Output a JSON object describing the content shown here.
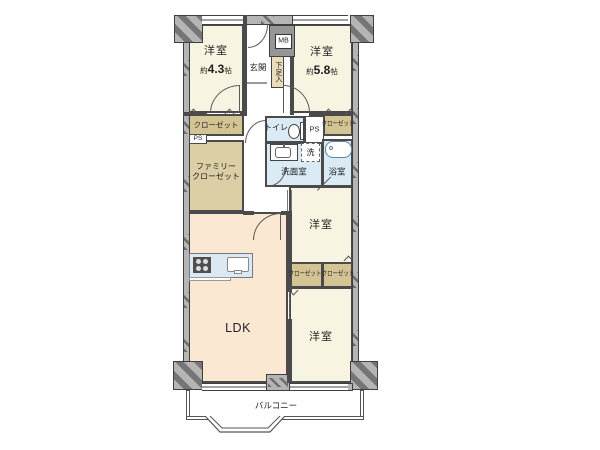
{
  "plan": {
    "rooms": {
      "bedroom_tl": {
        "label": "洋室",
        "size_approx": "約",
        "size_value": "4.3",
        "size_unit": "帖"
      },
      "bedroom_tr": {
        "label": "洋室",
        "size_approx": "約",
        "size_value": "5.8",
        "size_unit": "帖"
      },
      "entrance": {
        "label": "玄関"
      },
      "meter_box": {
        "label": "MB"
      },
      "shoe_cabinet": {
        "label": "下足入"
      },
      "closet_tl": {
        "label": "クローゼット"
      },
      "pipe_shaft_left": {
        "label": "PS"
      },
      "family_closet": {
        "label_line1": "ファミリー",
        "label_line2": "クローゼット"
      },
      "toilet": {
        "label": "トイレ"
      },
      "pipe_shaft_center": {
        "label": "PS"
      },
      "closet_tr": {
        "label": "クローゼット"
      },
      "washroom": {
        "label": "洗面室"
      },
      "washer": {
        "label": "洗"
      },
      "bathroom": {
        "label": "浴室"
      },
      "bedroom_mid": {
        "label": "洋室"
      },
      "closet_mid_left": {
        "label": "クローゼット"
      },
      "closet_mid_right": {
        "label": "クローゼット"
      },
      "ldk": {
        "label": "LDK"
      },
      "bedroom_bottom": {
        "label": "洋室"
      },
      "balcony": {
        "label": "バルコニー"
      }
    },
    "colors": {
      "room_cream": "#f8f4e2",
      "ldk_peach": "#fae8d3",
      "closet_tan": "#d5c493",
      "closet_tan_light": "#dccfa6",
      "water_blue": "#daebf6",
      "shoe_beige": "#e9ddbc",
      "wall_gray": "#b5b5b5",
      "wall_line": "#3f3f3f",
      "inner_wall": "#4a4a4a",
      "shaft_gray": "#969696",
      "counter_blue": "#dde9f2",
      "tub_blue": "#5b86a3",
      "arc_line": "#5a5a5a",
      "text_color": "#222222"
    }
  }
}
